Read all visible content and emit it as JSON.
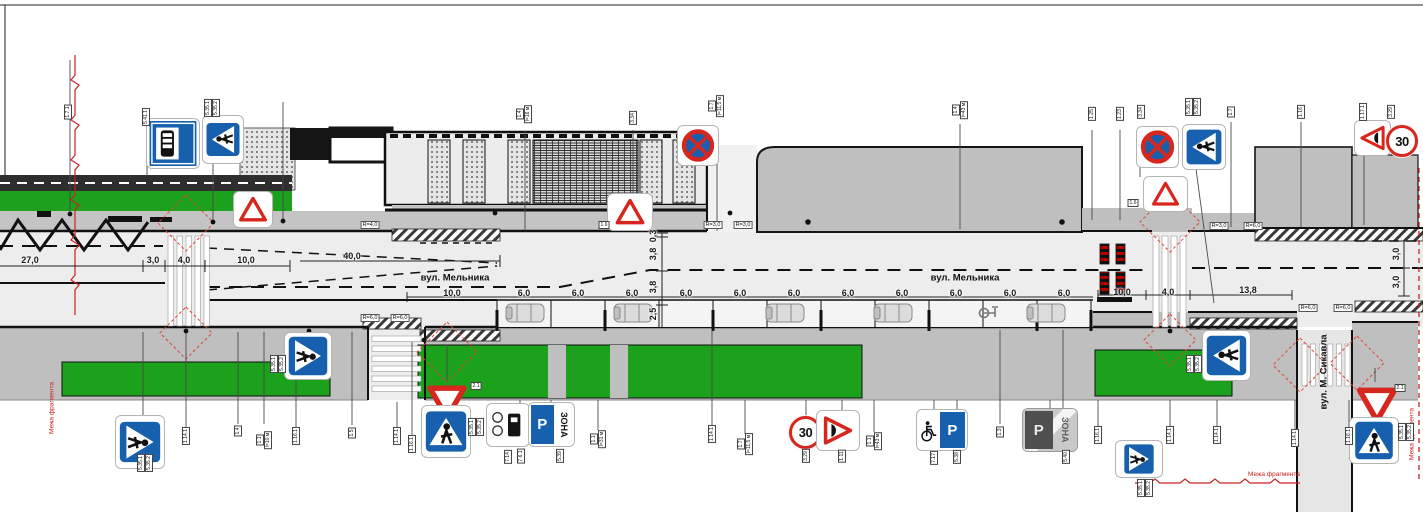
{
  "streets": {
    "main_left": "вул. Мельника",
    "main_right": "вул. Мельника",
    "cross": "вул. М. Сикавла"
  },
  "boundary": {
    "left": "Межа фрагмента",
    "right": "Межа фрагмента",
    "bottom": "Межа фрагмента"
  },
  "signs": {
    "speed_limit": "30",
    "parking": "P",
    "zone": "ЗОНА"
  },
  "dimension_labels": [
    {
      "t": "27,0",
      "x": 30,
      "y": 260
    },
    {
      "t": "3,0",
      "x": 153,
      "y": 260
    },
    {
      "t": "4,0",
      "x": 184,
      "y": 260
    },
    {
      "t": "10,0",
      "x": 246,
      "y": 260
    },
    {
      "t": "40,0",
      "x": 352,
      "y": 256
    },
    {
      "t": "10,0",
      "x": 452,
      "y": 293
    },
    {
      "t": "6,0",
      "x": 524,
      "y": 293
    },
    {
      "t": "6,0",
      "x": 578,
      "y": 293
    },
    {
      "t": "6,0",
      "x": 632,
      "y": 293
    },
    {
      "t": "6,0",
      "x": 686,
      "y": 293
    },
    {
      "t": "6,0",
      "x": 740,
      "y": 293
    },
    {
      "t": "6,0",
      "x": 794,
      "y": 293
    },
    {
      "t": "6,0",
      "x": 848,
      "y": 293
    },
    {
      "t": "6,0",
      "x": 902,
      "y": 293
    },
    {
      "t": "6,0",
      "x": 956,
      "y": 293
    },
    {
      "t": "6,0",
      "x": 1010,
      "y": 293
    },
    {
      "t": "6,0",
      "x": 1064,
      "y": 293
    },
    {
      "t": "10,0",
      "x": 1122,
      "y": 292
    },
    {
      "t": "4,0",
      "x": 1168,
      "y": 292
    },
    {
      "t": "13,8",
      "x": 1248,
      "y": 290
    },
    {
      "t": "0,3",
      "x": 653,
      "y": 236,
      "v": 1
    },
    {
      "t": "3,8",
      "x": 653,
      "y": 254,
      "v": 1
    },
    {
      "t": "3,8",
      "x": 653,
      "y": 287,
      "v": 1
    },
    {
      "t": "2,5",
      "x": 653,
      "y": 314,
      "v": 1
    },
    {
      "t": "3,0",
      "x": 1396,
      "y": 254,
      "v": 1
    },
    {
      "t": "3,0",
      "x": 1396,
      "y": 282,
      "v": 1
    }
  ],
  "radius_labels": [
    {
      "t": "R=4,0",
      "x": 370,
      "y": 225
    },
    {
      "t": "R=3,0",
      "x": 713,
      "y": 225
    },
    {
      "t": "R=3,0",
      "x": 743,
      "y": 225
    },
    {
      "t": "R=3,0",
      "x": 1219,
      "y": 226
    },
    {
      "t": "R=6,0",
      "x": 1253,
      "y": 226
    },
    {
      "t": "R=6,0",
      "x": 370,
      "y": 318
    },
    {
      "t": "R=6,0",
      "x": 400,
      "y": 318
    },
    {
      "t": "R=6,0",
      "x": 1308,
      "y": 308
    },
    {
      "t": "R=6,0",
      "x": 1343,
      "y": 308
    }
  ],
  "code_labels": [
    {
      "t": "1.7.1",
      "x": 68,
      "y": 112
    },
    {
      "t": "5.41.1",
      "x": 146,
      "y": 117
    },
    {
      "t": "5.35.1",
      "x": 208,
      "y": 108
    },
    {
      "t": "5.35.2",
      "x": 216,
      "y": 108
    },
    {
      "t": "1.4",
      "x": 520,
      "y": 114
    },
    {
      "t": "l=16 м",
      "x": 528,
      "y": 114
    },
    {
      "t": "3.34",
      "x": 633,
      "y": 118
    },
    {
      "t": "1.7",
      "x": 712,
      "y": 106
    },
    {
      "t": "l=11,5 м",
      "x": 720,
      "y": 106
    },
    {
      "t": "1.4",
      "x": 956,
      "y": 110
    },
    {
      "t": "l=43 м",
      "x": 964,
      "y": 110
    },
    {
      "t": "1.25",
      "x": 1092,
      "y": 114
    },
    {
      "t": "1.23",
      "x": 1120,
      "y": 114
    },
    {
      "t": "3.34",
      "x": 1141,
      "y": 112
    },
    {
      "t": "5.35.1",
      "x": 1189,
      "y": 107
    },
    {
      "t": "5.35.2",
      "x": 1197,
      "y": 107
    },
    {
      "t": "1.7",
      "x": 1231,
      "y": 112
    },
    {
      "t": "1.16",
      "x": 1301,
      "y": 112
    },
    {
      "t": "1.17.1",
      "x": 1363,
      "y": 112
    },
    {
      "t": "3.29",
      "x": 1391,
      "y": 112
    },
    {
      "t": "1.6",
      "x": 604,
      "y": 225,
      "h": 1
    },
    {
      "t": "1.6",
      "x": 1133,
      "y": 203,
      "h": 1
    },
    {
      "t": "5.35.1",
      "x": 141,
      "y": 463
    },
    {
      "t": "5.35.2",
      "x": 149,
      "y": 463
    },
    {
      "t": "1.14.1",
      "x": 186,
      "y": 436
    },
    {
      "t": "1.4",
      "x": 238,
      "y": 431
    },
    {
      "t": "1.1",
      "x": 260,
      "y": 440
    },
    {
      "t": "l=10 м",
      "x": 268,
      "y": 440
    },
    {
      "t": "1.16.1",
      "x": 296,
      "y": 436
    },
    {
      "t": "5.35.1",
      "x": 274,
      "y": 364
    },
    {
      "t": "5.35.2",
      "x": 282,
      "y": 364
    },
    {
      "t": "1.5",
      "x": 352,
      "y": 433
    },
    {
      "t": "1.14.1",
      "x": 397,
      "y": 436
    },
    {
      "t": "1.16.1",
      "x": 412,
      "y": 444
    },
    {
      "t": "2.1",
      "x": 476,
      "y": 386,
      "h": 1
    },
    {
      "t": "5.35.1",
      "x": 472,
      "y": 427
    },
    {
      "t": "5.35.2",
      "x": 480,
      "y": 427
    },
    {
      "t": "7.14",
      "x": 508,
      "y": 457
    },
    {
      "t": "7.6.1",
      "x": 521,
      "y": 456
    },
    {
      "t": "5.39",
      "x": 560,
      "y": 456
    },
    {
      "t": "1.1",
      "x": 594,
      "y": 439
    },
    {
      "t": "l=31 м",
      "x": 602,
      "y": 439
    },
    {
      "t": "1.14.1",
      "x": 712,
      "y": 434
    },
    {
      "t": "1.7",
      "x": 741,
      "y": 444
    },
    {
      "t": "l=11,5 м",
      "x": 749,
      "y": 444
    },
    {
      "t": "3.29",
      "x": 806,
      "y": 456
    },
    {
      "t": "1.11",
      "x": 842,
      "y": 456
    },
    {
      "t": "1.1",
      "x": 870,
      "y": 441
    },
    {
      "t": "l=43 м",
      "x": 878,
      "y": 441
    },
    {
      "t": "7.17",
      "x": 934,
      "y": 458
    },
    {
      "t": "5.38",
      "x": 957,
      "y": 457
    },
    {
      "t": "1.3",
      "x": 1000,
      "y": 432
    },
    {
      "t": "5.40",
      "x": 1066,
      "y": 457
    },
    {
      "t": "1.16.1",
      "x": 1098,
      "y": 435
    },
    {
      "t": "1.14.1",
      "x": 1170,
      "y": 435
    },
    {
      "t": "1.14.1",
      "x": 1217,
      "y": 435
    },
    {
      "t": "5.35.1",
      "x": 1190,
      "y": 364
    },
    {
      "t": "5.35.2",
      "x": 1198,
      "y": 364
    },
    {
      "t": "5.35.1",
      "x": 1141,
      "y": 488
    },
    {
      "t": "5.35.2",
      "x": 1149,
      "y": 488
    },
    {
      "t": "1.14.1",
      "x": 1295,
      "y": 438
    },
    {
      "t": "1.16.1",
      "x": 1349,
      "y": 436
    },
    {
      "t": "2.1",
      "x": 1400,
      "y": 388,
      "h": 1
    },
    {
      "t": "5.35.1",
      "x": 1402,
      "y": 432
    },
    {
      "t": "5.35.2",
      "x": 1410,
      "y": 432
    }
  ]
}
